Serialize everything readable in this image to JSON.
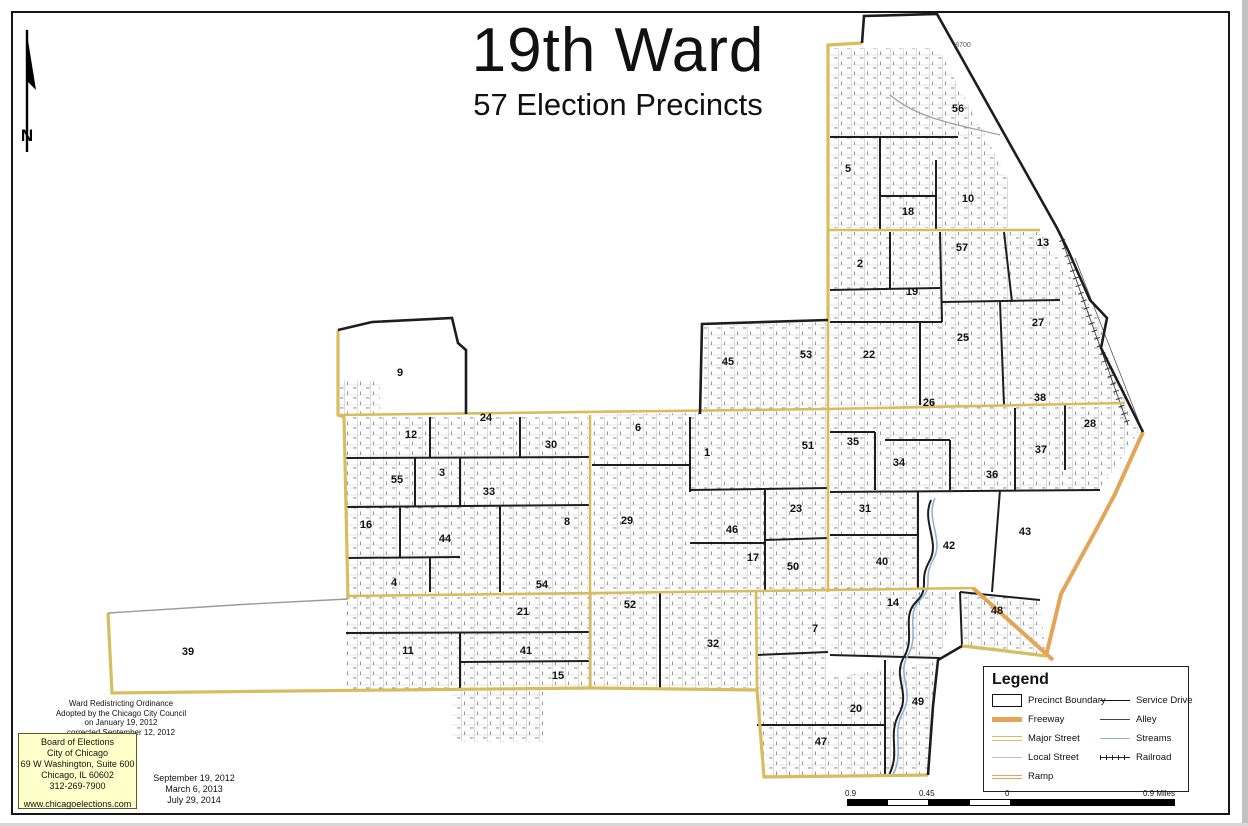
{
  "page": {
    "title": "19th Ward",
    "subtitle": "57 Election Precincts"
  },
  "north": {
    "label": "N"
  },
  "ordinance": {
    "lines": [
      "Ward Redistricting Ordinance",
      "Adopted by the Chicago City Council",
      "on January 19, 2012",
      "corrected September 12, 2012"
    ]
  },
  "board": {
    "lines": [
      "Board of Elections",
      "City of Chicago",
      "69 W Washington, Suite 600",
      "Chicago, IL 60602",
      "312-269-7900",
      "www.chicagoelections.com"
    ]
  },
  "revision_dates": {
    "lines": [
      "September 19, 2012",
      "March 6, 2013",
      "July 29, 2014"
    ]
  },
  "legend": {
    "title": "Legend",
    "left": [
      {
        "label": "Precinct Boundary",
        "swatch": "precinct-boundary"
      },
      {
        "label": "Freeway",
        "swatch": "freeway"
      },
      {
        "label": "Major Street",
        "swatch": "major-street"
      },
      {
        "label": "Local Street",
        "swatch": "local-street"
      },
      {
        "label": "Ramp",
        "swatch": "ramp"
      }
    ],
    "right": [
      {
        "label": "Service Drive",
        "swatch": "service-drive"
      },
      {
        "label": "Alley",
        "swatch": "alley"
      },
      {
        "label": "Streams",
        "swatch": "streams"
      },
      {
        "label": "Railroad",
        "swatch": "railroad"
      }
    ]
  },
  "scale": {
    "labels": [
      "0.9",
      "0.45",
      "0",
      "0.9 Miles"
    ]
  },
  "colors": {
    "boundary_yellow": "#D8BD5E",
    "freeway_orange": "#E4A558",
    "precinct_black": "#1d1d1d",
    "stream_blue": "#8FB4D9",
    "info_box_yellow": "#FFFFC9"
  },
  "map": {
    "ward_number": "19",
    "precinct_count": 57,
    "edge_labels": [
      {
        "text": "8700",
        "x": 963,
        "y": 47
      }
    ],
    "precincts": [
      {
        "n": 1,
        "x": 707,
        "y": 452
      },
      {
        "n": 2,
        "x": 860,
        "y": 263
      },
      {
        "n": 3,
        "x": 442,
        "y": 472
      },
      {
        "n": 4,
        "x": 394,
        "y": 582
      },
      {
        "n": 5,
        "x": 848,
        "y": 168
      },
      {
        "n": 6,
        "x": 638,
        "y": 427
      },
      {
        "n": 7,
        "x": 815,
        "y": 628
      },
      {
        "n": 8,
        "x": 567,
        "y": 521
      },
      {
        "n": 9,
        "x": 400,
        "y": 372
      },
      {
        "n": 10,
        "x": 968,
        "y": 198
      },
      {
        "n": 11,
        "x": 408,
        "y": 650
      },
      {
        "n": 12,
        "x": 411,
        "y": 434
      },
      {
        "n": 13,
        "x": 1043,
        "y": 242
      },
      {
        "n": 14,
        "x": 893,
        "y": 602
      },
      {
        "n": 15,
        "x": 558,
        "y": 675
      },
      {
        "n": 16,
        "x": 366,
        "y": 524
      },
      {
        "n": 17,
        "x": 753,
        "y": 557
      },
      {
        "n": 18,
        "x": 908,
        "y": 211
      },
      {
        "n": 19,
        "x": 912,
        "y": 291
      },
      {
        "n": 20,
        "x": 856,
        "y": 708
      },
      {
        "n": 21,
        "x": 523,
        "y": 611
      },
      {
        "n": 22,
        "x": 869,
        "y": 354
      },
      {
        "n": 23,
        "x": 796,
        "y": 508
      },
      {
        "n": 24,
        "x": 486,
        "y": 417
      },
      {
        "n": 25,
        "x": 963,
        "y": 337
      },
      {
        "n": 26,
        "x": 929,
        "y": 402
      },
      {
        "n": 27,
        "x": 1038,
        "y": 322
      },
      {
        "n": 28,
        "x": 1090,
        "y": 423
      },
      {
        "n": 29,
        "x": 627,
        "y": 520
      },
      {
        "n": 30,
        "x": 551,
        "y": 444
      },
      {
        "n": 31,
        "x": 865,
        "y": 508
      },
      {
        "n": 32,
        "x": 713,
        "y": 643
      },
      {
        "n": 33,
        "x": 489,
        "y": 491
      },
      {
        "n": 34,
        "x": 899,
        "y": 462
      },
      {
        "n": 35,
        "x": 853,
        "y": 441
      },
      {
        "n": 36,
        "x": 992,
        "y": 474
      },
      {
        "n": 37,
        "x": 1041,
        "y": 449
      },
      {
        "n": 38,
        "x": 1040,
        "y": 397
      },
      {
        "n": 39,
        "x": 188,
        "y": 651
      },
      {
        "n": 40,
        "x": 882,
        "y": 561
      },
      {
        "n": 41,
        "x": 526,
        "y": 650
      },
      {
        "n": 42,
        "x": 949,
        "y": 545
      },
      {
        "n": 43,
        "x": 1025,
        "y": 531
      },
      {
        "n": 44,
        "x": 445,
        "y": 538
      },
      {
        "n": 45,
        "x": 728,
        "y": 361
      },
      {
        "n": 46,
        "x": 732,
        "y": 529
      },
      {
        "n": 47,
        "x": 821,
        "y": 741
      },
      {
        "n": 48,
        "x": 997,
        "y": 610
      },
      {
        "n": 49,
        "x": 918,
        "y": 701
      },
      {
        "n": 50,
        "x": 793,
        "y": 566
      },
      {
        "n": 51,
        "x": 808,
        "y": 445
      },
      {
        "n": 52,
        "x": 630,
        "y": 604
      },
      {
        "n": 53,
        "x": 806,
        "y": 354
      },
      {
        "n": 54,
        "x": 542,
        "y": 584
      },
      {
        "n": 55,
        "x": 397,
        "y": 479
      },
      {
        "n": 56,
        "x": 958,
        "y": 108
      },
      {
        "n": 57,
        "x": 962,
        "y": 247
      }
    ]
  }
}
